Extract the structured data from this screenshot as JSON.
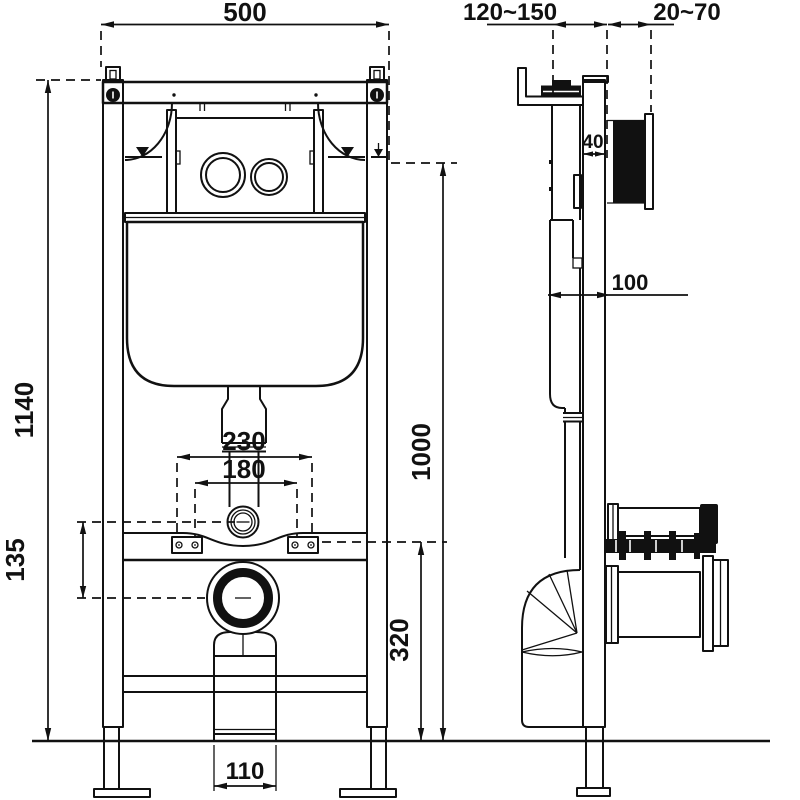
{
  "colors": {
    "ink": "#111111",
    "background": "#ffffff"
  },
  "dimensions": {
    "front_width": "500",
    "total_height": "1140",
    "plate_center_height": "1000",
    "outlet_center_height": "320",
    "inlet_offset": "135",
    "stud_spacing_wide": "230",
    "stud_spacing_narrow": "180",
    "drain_width": "110",
    "depth_adjust_range": "120~150",
    "wall_finish_range": "20~70",
    "rail_depth": "40",
    "unit_depth": "100"
  }
}
